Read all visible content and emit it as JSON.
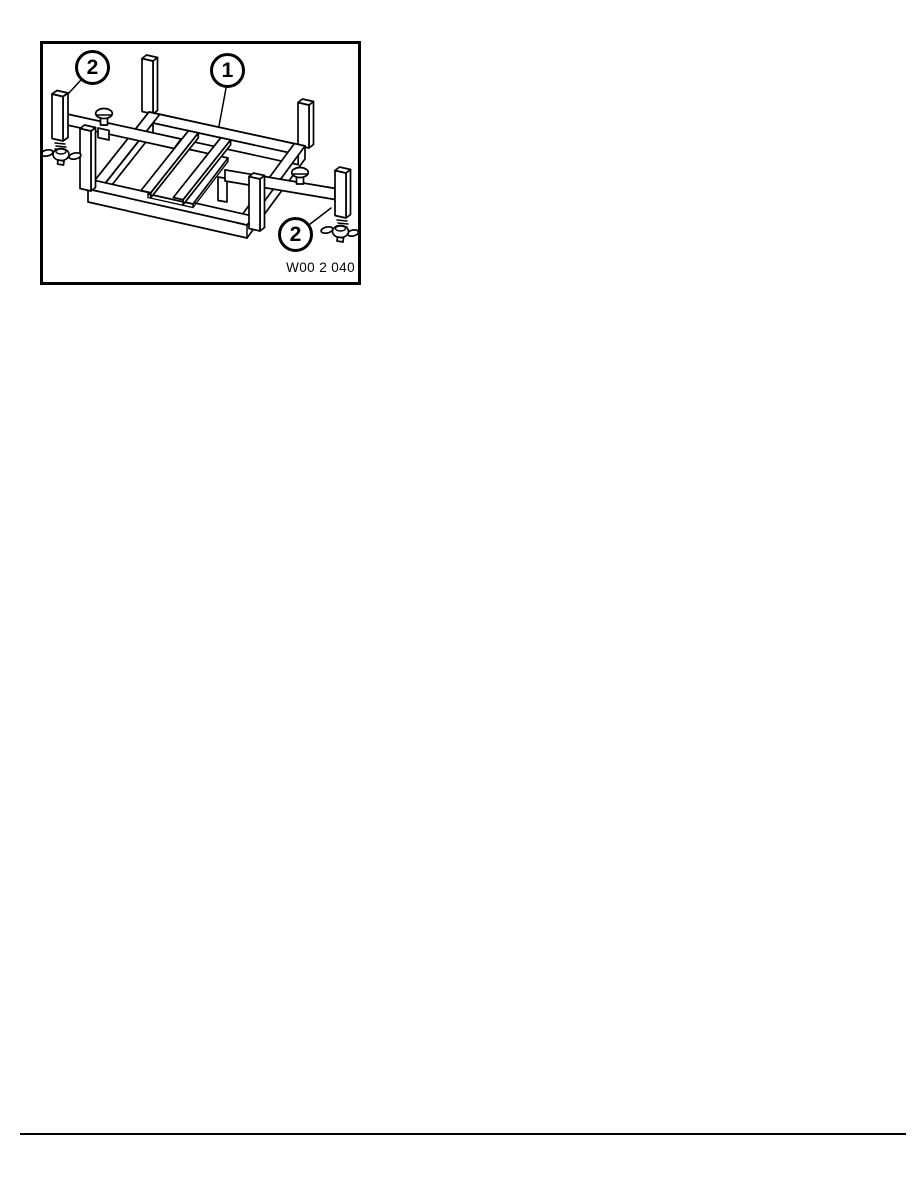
{
  "figure": {
    "caption": "W00 2 040",
    "callouts": [
      {
        "label": "2"
      },
      {
        "label": "1"
      },
      {
        "label": "2"
      }
    ]
  },
  "colors": {
    "line": "#000000",
    "paper": "#ffffff"
  }
}
